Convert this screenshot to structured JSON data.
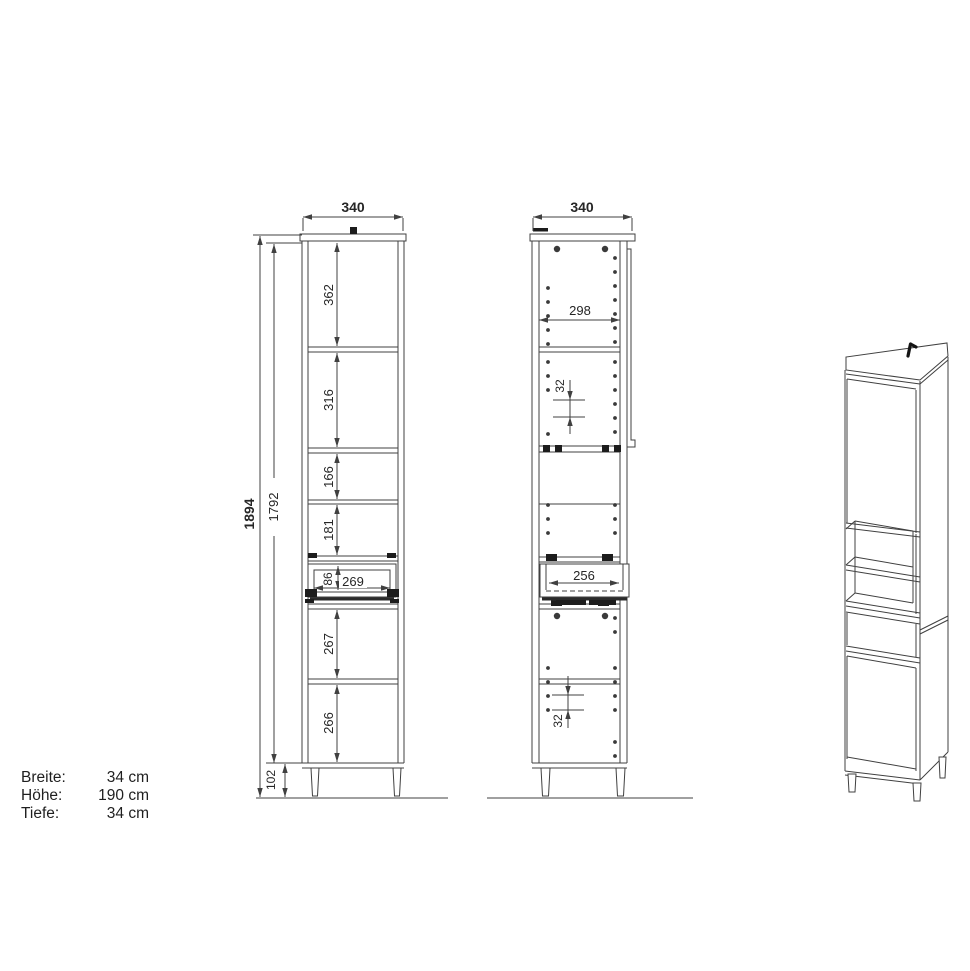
{
  "colors": {
    "line": "#404040",
    "text": "#262626",
    "background": "#ffffff",
    "black_detail": "#1c1c1c"
  },
  "front_view": {
    "width": "340",
    "height_total": "1894",
    "height_carcass": "1792",
    "comp_1": "362",
    "comp_2": "316",
    "comp_3": "166",
    "comp_4": "181",
    "drawer_inner_height": "86",
    "drawer_inner_width": "269",
    "comp_5": "267",
    "comp_6": "266",
    "plinth_height": "102"
  },
  "interior_view": {
    "width": "340",
    "inner_width": "298",
    "hole_pitch_upper": "32",
    "drawer_inner_width": "256",
    "hole_pitch_lower": "32"
  },
  "info_panel": {
    "width_label": "Breite:",
    "width_value": "34 cm",
    "height_label": "Höhe:",
    "height_value": "190 cm",
    "depth_label": "Tiefe:",
    "depth_value": "34 cm"
  }
}
